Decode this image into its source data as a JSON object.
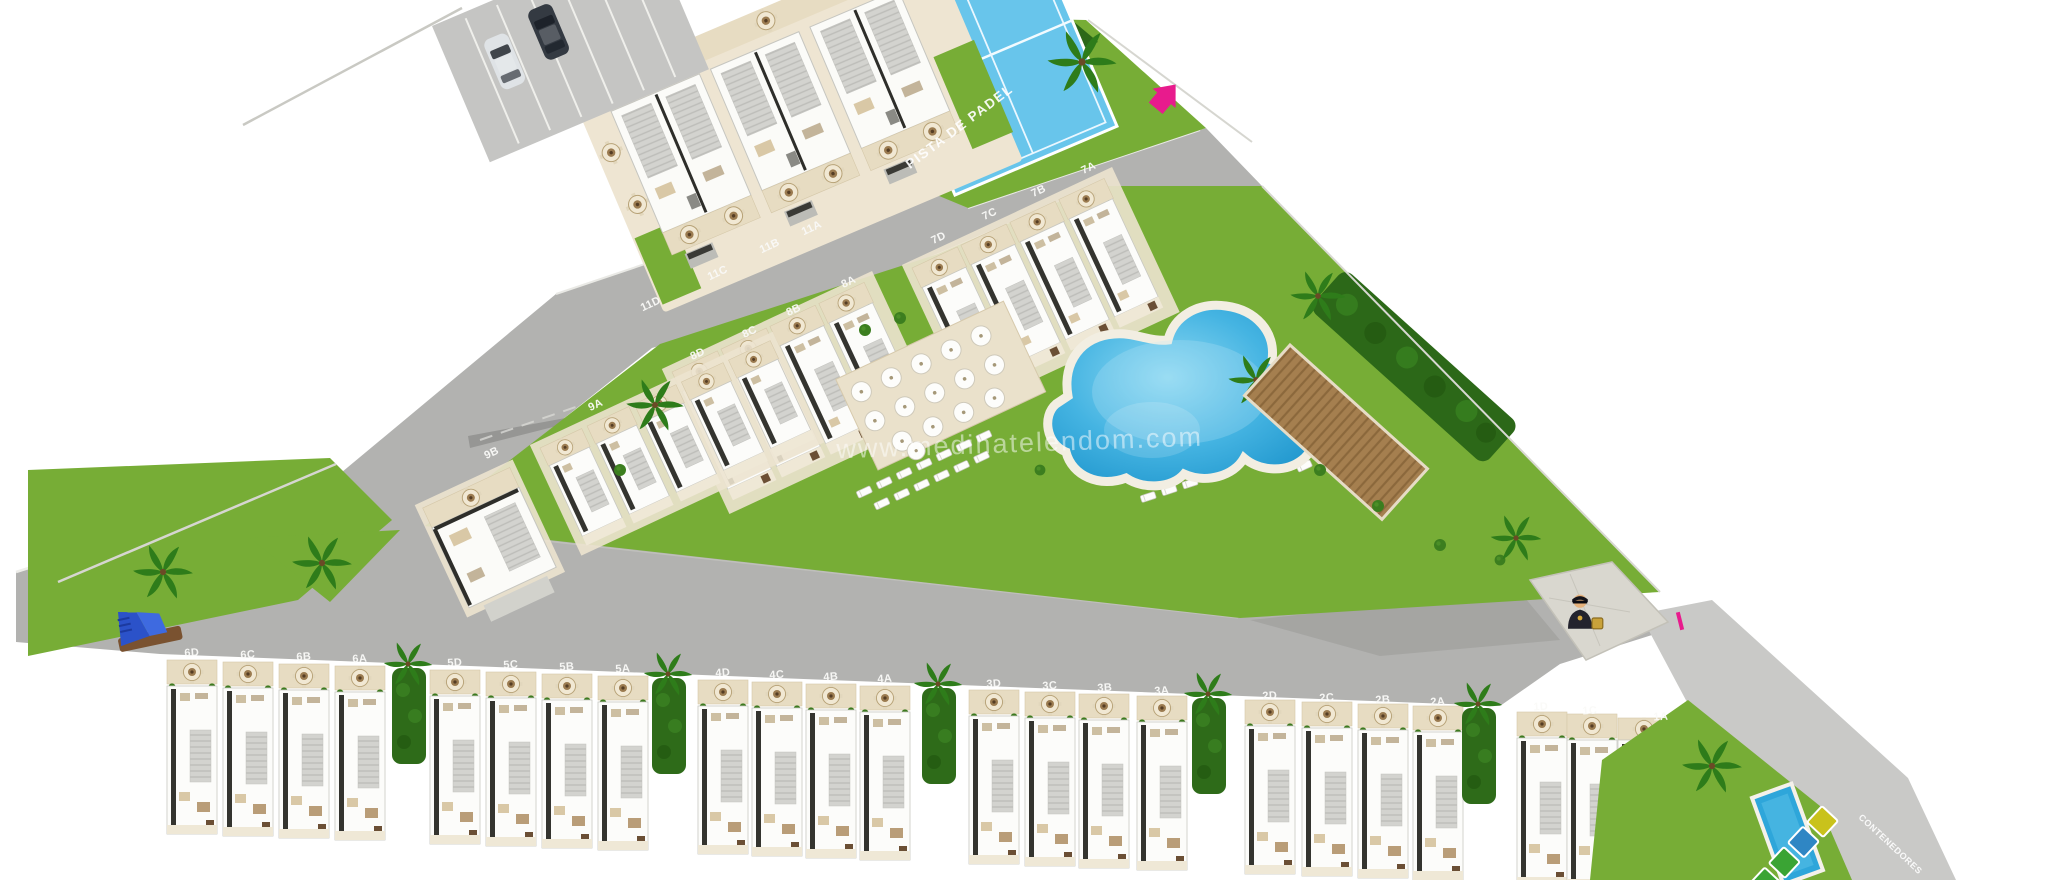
{
  "plan": {
    "watermark": "www.medinatelendom.com",
    "padel_court_label": "PISTA DE PADEL",
    "containers_label": "CONTENEDORES",
    "unit_labels": {
      "row11": [
        "11A",
        "11B",
        "11C",
        "11D"
      ],
      "row9": [
        "9A",
        "9B"
      ],
      "row8": [
        "8A",
        "8B",
        "8C",
        "8D"
      ],
      "row7": [
        "7A",
        "7B",
        "7C",
        "7D"
      ],
      "row6": [
        "6D",
        "6C",
        "6B",
        "6A"
      ],
      "row5": [
        "5D",
        "5C",
        "5B",
        "5A"
      ],
      "row4": [
        "4D",
        "4C",
        "4B",
        "4A"
      ],
      "row3": [
        "3D",
        "3C",
        "3B",
        "3A"
      ],
      "row2": [
        "2D",
        "2C",
        "2B",
        "2A"
      ],
      "row1": [
        "1D",
        "1C",
        "1A"
      ]
    },
    "icons": {
      "entrance_arrow": "pink arrow pointing north-east (site entrance)",
      "security_guard": "security guard post",
      "container_bins": [
        "yellow",
        "blue",
        "green",
        "green"
      ]
    },
    "colors": {
      "accent_pink": "#e81b8d",
      "pool_blue": "#31abdd",
      "padel_blue": "#68c5eb",
      "grass_green": "#77ad36",
      "asphalt_gray": "#b2b2b0"
    }
  }
}
